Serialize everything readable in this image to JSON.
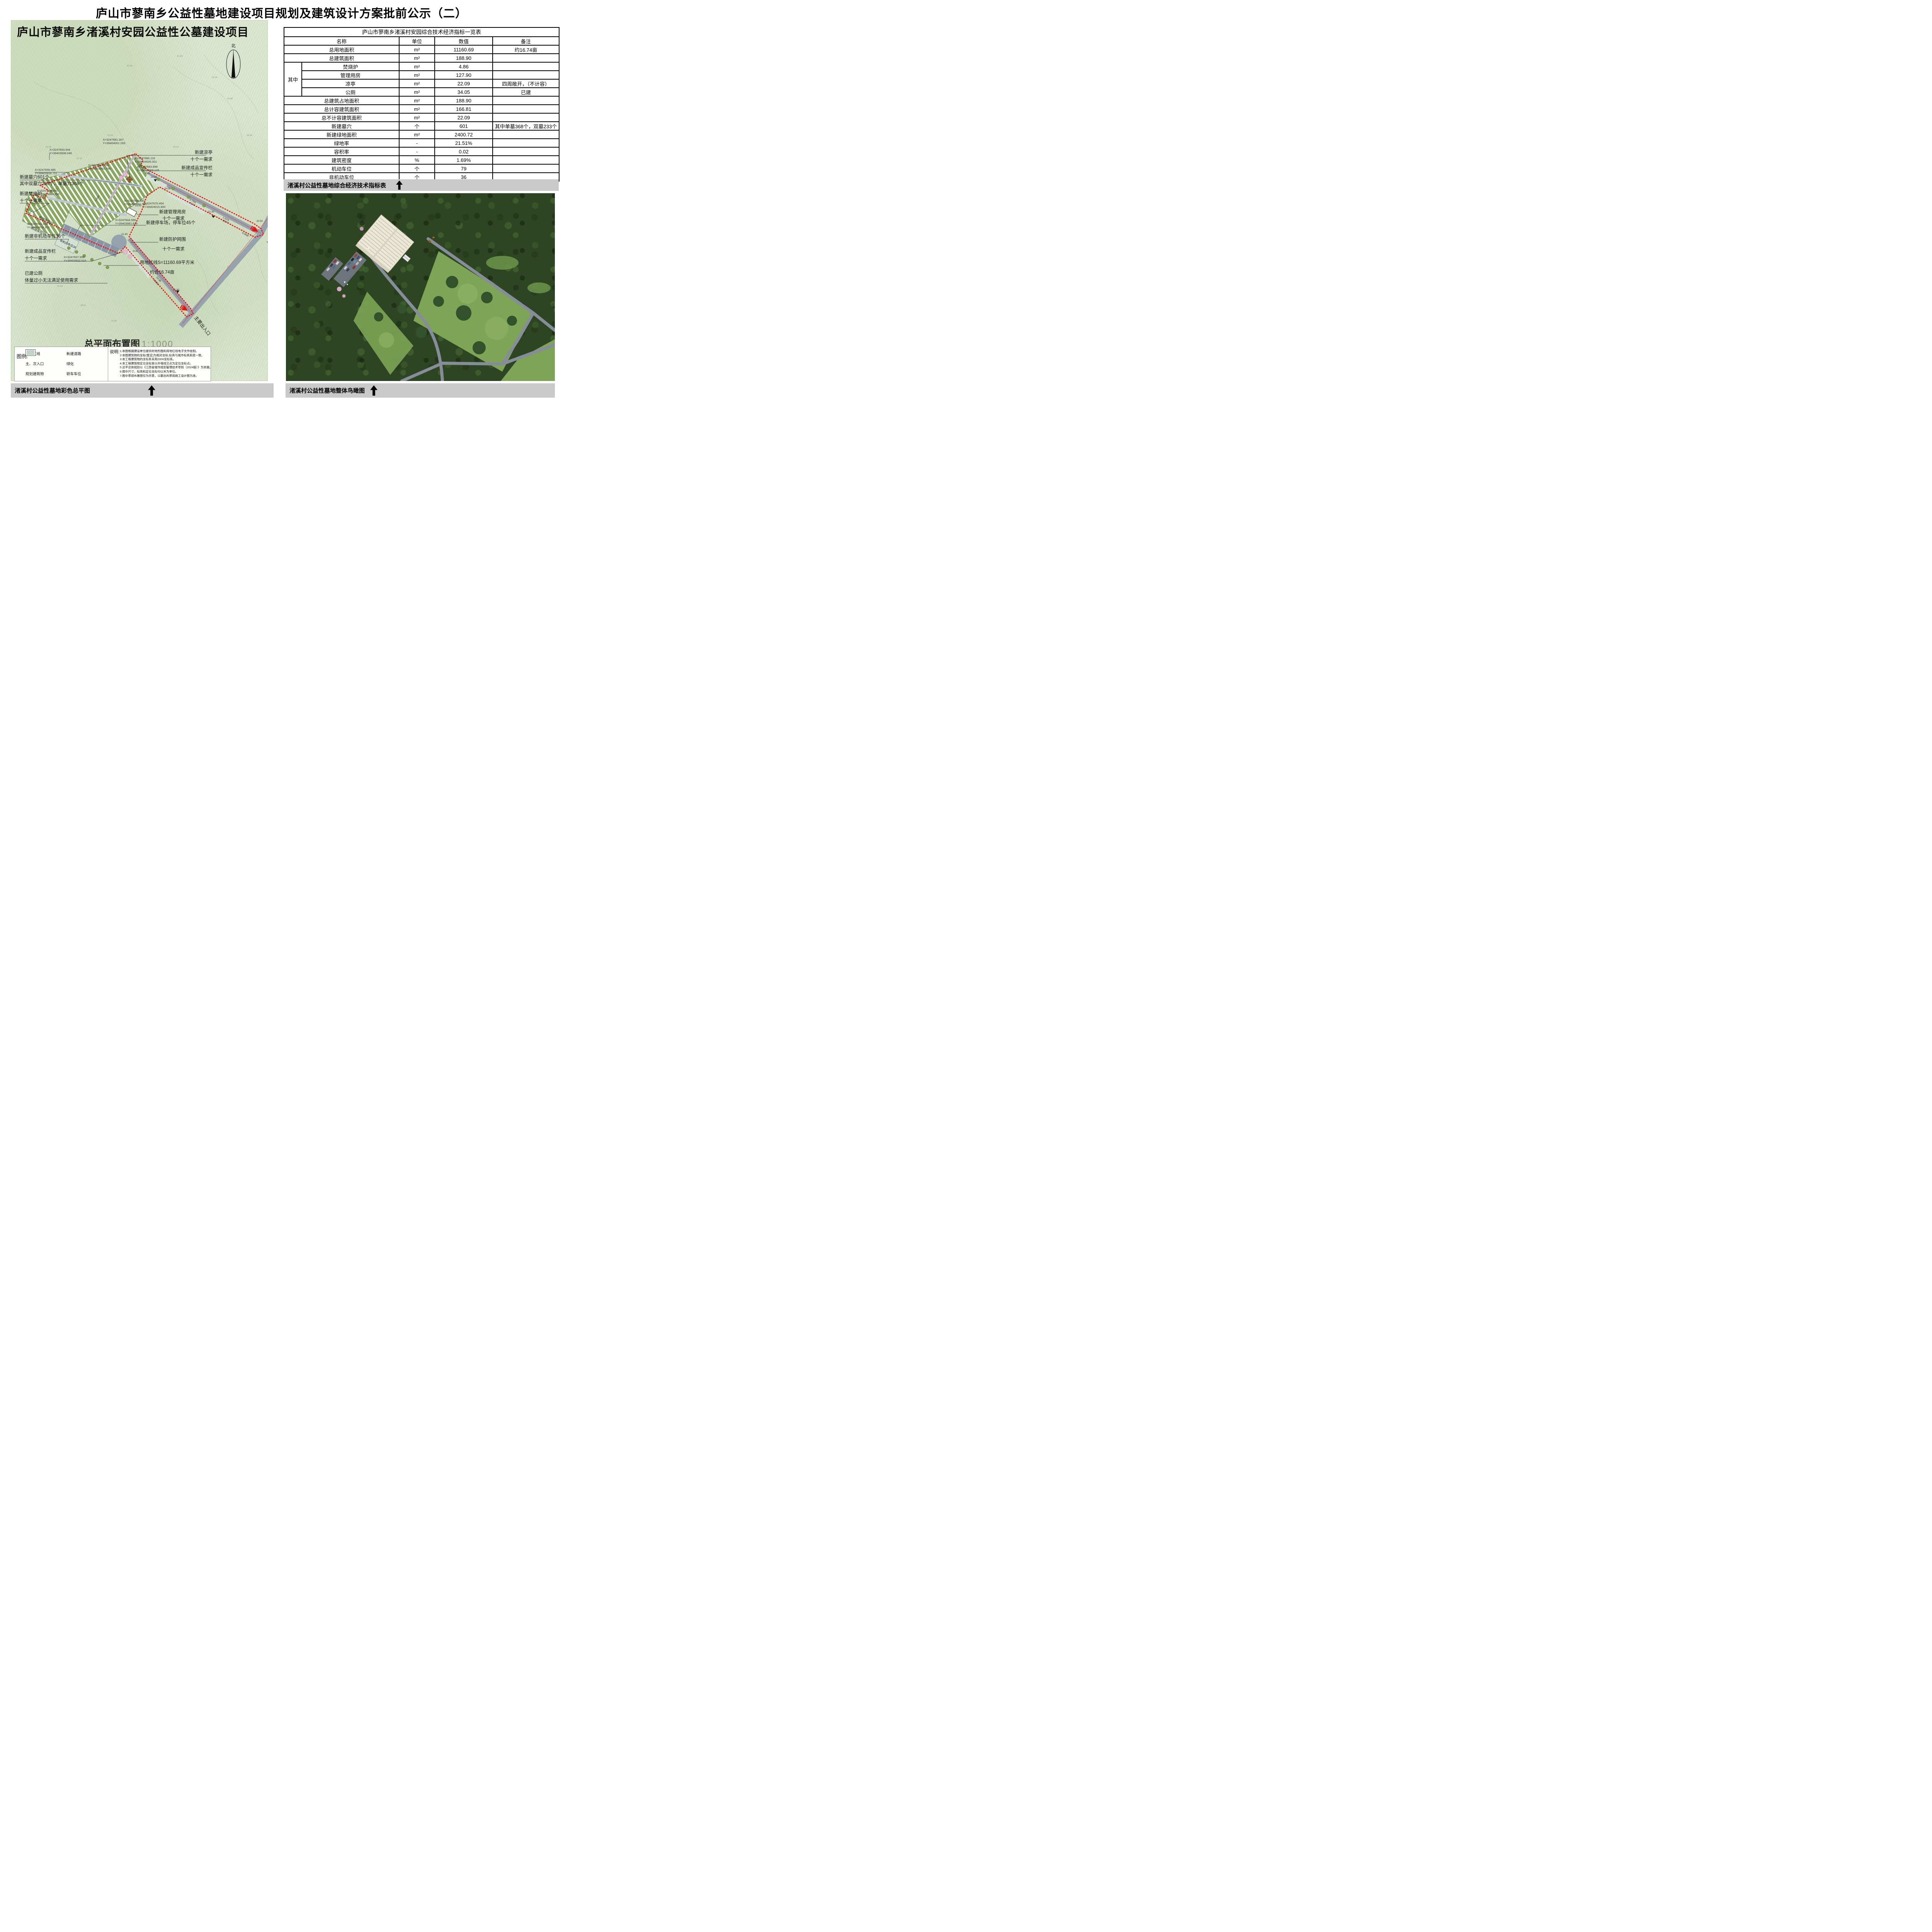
{
  "page": {
    "title": "庐山市蓼南乡公益性墓地建设项目规划及建筑设计方案批前公示（二）"
  },
  "plan": {
    "title": "庐山市蓼南乡渚溪村安园公益性公墓建设项目",
    "north": "北",
    "scale": {
      "label": "总平面布置图",
      "value": "1:1000"
    },
    "annotations": {
      "new_graves": "新建墓穴601个",
      "new_graves_sub": "其中双墓穴233个，单墓穴368个",
      "incinerator": "新建焚烧炉",
      "need": "十个一需求",
      "non_motor": "新建非机动车位36个",
      "bulletin": "新建成品宣传栏",
      "toilet": "已建公厕",
      "toilet_sub": "体量过小无法满足使用需求",
      "pavilion": "新建凉亭",
      "mgmt": "新建管理用房",
      "parking45": "新建停车场，停车位45个",
      "fence": "新建防护网围",
      "redline": "用地红线S=11160.69平方米",
      "redline_sub": "约合16.74亩",
      "entrance": "主要出入口",
      "parking19": "机动车位19",
      "parking15": "机动车位15",
      "non_motor36": "非机动车位36"
    },
    "coords": [
      {
        "x": "X=3247693.344",
        "y": "Y=39403936.046"
      },
      {
        "x": "X=3247658.485",
        "y": "Y=39403916.711"
      },
      {
        "x": "X=3247681.307",
        "y": "Y=39404001.293"
      },
      {
        "x": "X=3247686.116",
        "y": "Y=39404005.001"
      },
      {
        "x": "X=3247683.898",
        "y": "Y=39404009.145"
      },
      {
        "x": "X=3247665.438",
        "y": "Y=39403992.798"
      },
      {
        "x": "X=3247670.454",
        "y": "Y=39404015.900"
      },
      {
        "x": "X=3247658.481",
        "y": "Y=39403994.745"
      },
      {
        "x": "X=3247644.566",
        "y": "Y=39403981.625"
      },
      {
        "x": "X=3247648.940",
        "y": "Y=39403888.056"
      },
      {
        "x": "X=3247631.648",
        "y": "Y=39403878.373"
      },
      {
        "x": "X=3247607.950",
        "y": "Y=39403922.515"
      }
    ],
    "road_labels": [
      "0.73%",
      "41.24",
      "1.61%",
      "55.77",
      "6.00m",
      "1.60%",
      "24.98",
      "22.00",
      "22.30",
      "21.80",
      "21.50",
      "21.60",
      "20.50",
      "2.00m",
      "1.00m",
      "P=6",
      "P=29",
      "P=4"
    ],
    "spot_elevations": [
      "22.44",
      "21.93",
      "22.18",
      "23.40",
      "25.04",
      "22.20",
      "23.38",
      "21.42",
      "22.13",
      "21.64",
      "20.61",
      "21.37",
      "22.12",
      "21.56",
      "23.17"
    ],
    "legend": {
      "heading": "图例:",
      "items": [
        {
          "label": "用地红线",
          "icon": "red-line"
        },
        {
          "label": "新建道路",
          "icon": "gray-road"
        },
        {
          "label": "主、次入口",
          "icon": "entry-arrow"
        },
        {
          "label": "绿化",
          "icon": "greenery"
        },
        {
          "label": "规划建筑物",
          "icon": "building-outline"
        },
        {
          "label": "轿车车位",
          "icon": "parking"
        }
      ]
    },
    "notes": {
      "heading": "说明:",
      "items": [
        "1:本图根据建设单位提供的地形图和用地红线电子文件绘制。",
        "2:本图建筑物的坐标(暂定)为相对坐标,标高与城市标高系统一致。",
        "3:本工程建筑物的坐标系采用2000坐标系。",
        "4:本工程建筑物定位坐标是以外墙线交点为定位坐标点。",
        "5:总平总体规划以《江西省城市规划管理技术导则（2024版）》为依据。",
        "6:图中尺寸，标高和定位坐标均以米为单位。",
        "7:图中景观布置图仅为示意，以最后的景观施工设计图为准。"
      ]
    }
  },
  "table": {
    "title": "庐山市蓼南乡渚溪村安园综合技术经济指标一览表",
    "headers": [
      "名称",
      "单位",
      "数值",
      "备注"
    ],
    "group_label": "其中",
    "rows": [
      {
        "name": "总用地面积",
        "unit": "m²",
        "value": "11160.69",
        "note": "约16.74亩"
      },
      {
        "name": "总建筑面积",
        "unit": "m²",
        "value": "188.90",
        "note": ""
      },
      {
        "name": "焚烧炉",
        "unit": "m²",
        "value": "4.86",
        "note": ""
      },
      {
        "name": "管理用房",
        "unit": "m²",
        "value": "127.90",
        "note": ""
      },
      {
        "name": "凉亭",
        "unit": "m²",
        "value": "22.09",
        "note": "四周敞开，（不计容）"
      },
      {
        "name": "公厕",
        "unit": "m²",
        "value": "34.05",
        "note": "已建"
      },
      {
        "name": "总建筑占地面积",
        "unit": "m²",
        "value": "188.90",
        "note": ""
      },
      {
        "name": "总计容建筑面积",
        "unit": "m²",
        "value": "166.81",
        "note": ""
      },
      {
        "name": "总不计容建筑面积",
        "unit": "m²",
        "value": "22.09",
        "note": ""
      },
      {
        "name": "新建墓穴",
        "unit": "个",
        "value": "601",
        "note": "其中单墓368个，双墓233个"
      },
      {
        "name": "新建绿地面积",
        "unit": "m²",
        "value": "2400.72",
        "note": ""
      },
      {
        "name": "绿地率",
        "unit": "-",
        "value": "21.51%",
        "note": ""
      },
      {
        "name": "容积率",
        "unit": "-",
        "value": "0.02",
        "note": ""
      },
      {
        "name": "建筑密度",
        "unit": "%",
        "value": "1.69%",
        "note": ""
      },
      {
        "name": "机动车位",
        "unit": "个",
        "value": "79",
        "note": ""
      },
      {
        "name": "非机动车位",
        "unit": "个",
        "value": "36",
        "note": ""
      }
    ]
  },
  "captions": {
    "table": "渚溪村公益性墓地综合经济技术指标表",
    "plan": "渚溪村公益性墓地彩色总平图",
    "render": "渚溪村公益性墓地整体鸟瞰图"
  }
}
